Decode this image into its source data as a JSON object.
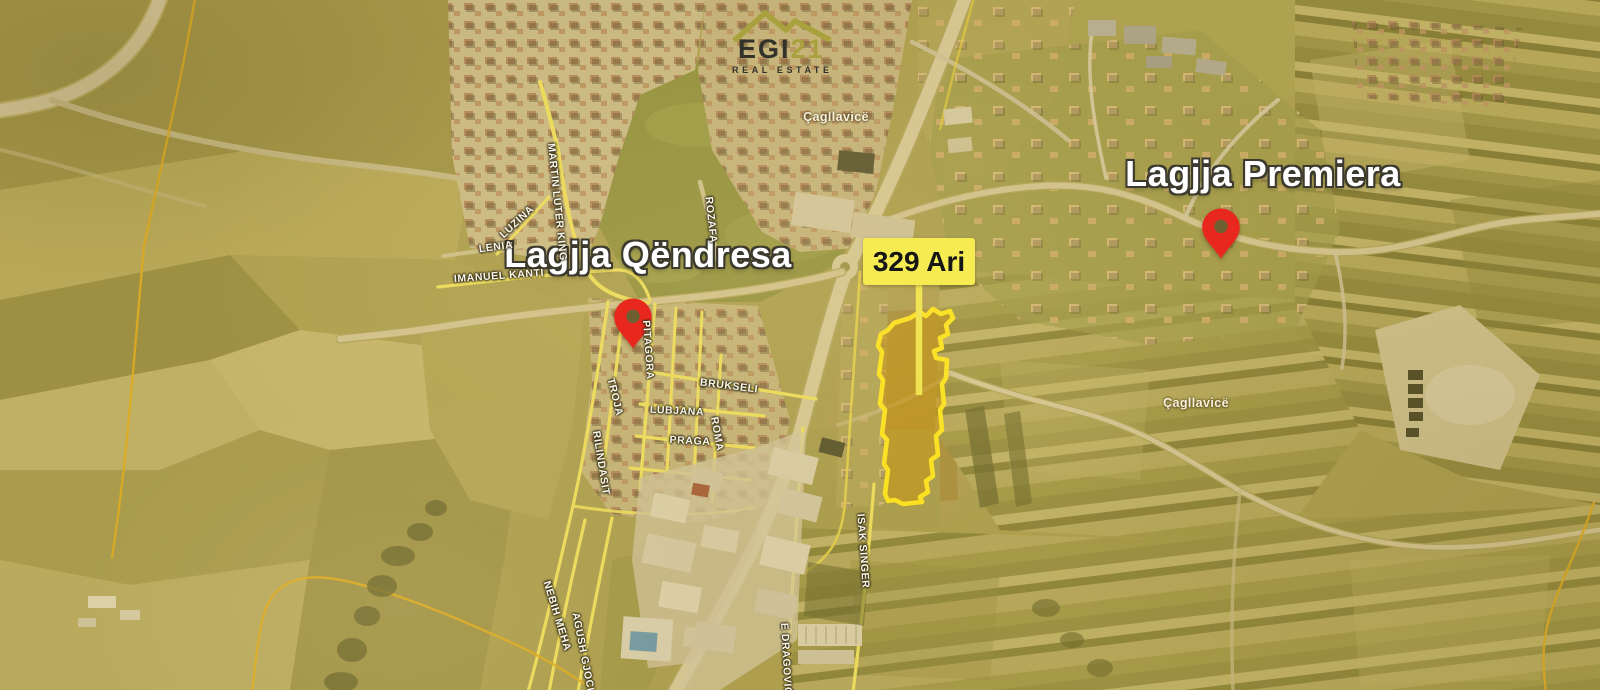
{
  "branding": {
    "name_main": "EGI",
    "name_number": "21",
    "tagline": "REAL ESTATE"
  },
  "area_labels": [
    {
      "label": "Lagjja Qëndresa"
    },
    {
      "label": "Lagjja Premiera"
    }
  ],
  "parcel": {
    "label": "329 Ari"
  },
  "place_labels": [
    {
      "label": "Çagllavicë"
    },
    {
      "label": "Çagllavicë"
    }
  ],
  "street_labels": [
    {
      "label": "MARTIN LUTER KING"
    },
    {
      "label": "LUZINA"
    },
    {
      "label": "LENIA"
    },
    {
      "label": "IMANUEL KANTI"
    },
    {
      "label": "ROZAFA"
    },
    {
      "label": "PITAGORA"
    },
    {
      "label": "TROJA"
    },
    {
      "label": "RILINDASIT"
    },
    {
      "label": "BRUKSELI"
    },
    {
      "label": "LUBJANA"
    },
    {
      "label": "PRAGA"
    },
    {
      "label": "ROMA"
    },
    {
      "label": "ISAK SINGER"
    },
    {
      "label": "NEBIH MEHA"
    },
    {
      "label": "AGUSH GJOCI"
    },
    {
      "label": "E DRAGOVIĆ"
    }
  ],
  "colors": {
    "pin": "#e8281e",
    "parcel_outline": "#ffe41c",
    "parcel_fill": "#c69212",
    "area_label_bg": "#f6ec52",
    "logo_accent": "#a9a13e",
    "logo_dark": "#32322b"
  }
}
